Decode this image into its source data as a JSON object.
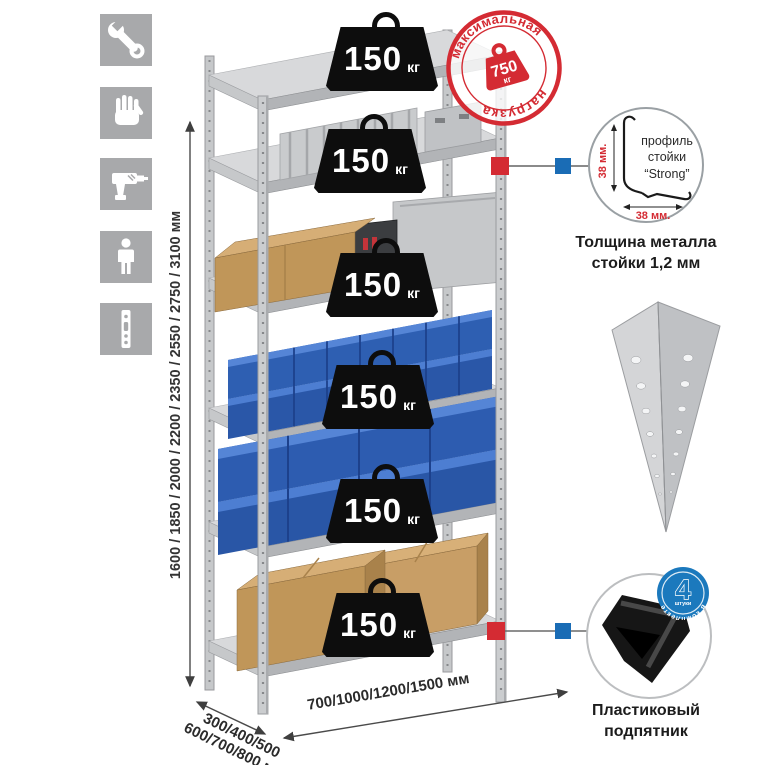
{
  "colors": {
    "red": "#d42b33",
    "blue_square": "#1a6cb5",
    "badge_blue": "#1b79bd",
    "tile_gray": "#a8a9ab",
    "metal_gray": "#c8c9cb",
    "bin_blue": "#2e5fb2",
    "cardboard": "#c49a62"
  },
  "sidebar": {
    "icons": [
      {
        "name": "wrench"
      },
      {
        "name": "gloves"
      },
      {
        "name": "drill"
      },
      {
        "name": "person"
      },
      {
        "name": "profile-strip"
      }
    ]
  },
  "dimensions": {
    "height": "1600 / 1850 / 2000 / 2200 / 2350 / 2550 / 2750 / 3100 мм",
    "depth_line1": "300/400/500",
    "depth_line2": "600/700/800 мм",
    "width": "700/1000/1200/1500 мм"
  },
  "weights": [
    {
      "value": "150",
      "unit": "кг"
    },
    {
      "value": "150",
      "unit": "кг"
    },
    {
      "value": "150",
      "unit": "кг"
    },
    {
      "value": "150",
      "unit": "кг"
    },
    {
      "value": "150",
      "unit": "кг"
    },
    {
      "value": "150",
      "unit": "кг"
    }
  ],
  "stamp": {
    "top_text": "максимальная",
    "bottom_text": "нагрузка",
    "value": "750",
    "unit": "кг"
  },
  "profile_detail": {
    "vertical_dim": "38 мм.",
    "horizontal_dim": "38 мм.",
    "label_line1": "профиль",
    "label_line2": "стойки",
    "label_line3": "“Strong”",
    "caption_line1": "Толщина металла",
    "caption_line2": "стойки 1,2 мм"
  },
  "foot_detail": {
    "badge_number": "4",
    "badge_sub": "штуки",
    "badge_arc": "в комплекте",
    "caption_line1": "Пластиковый",
    "caption_line2": "подпятник"
  }
}
